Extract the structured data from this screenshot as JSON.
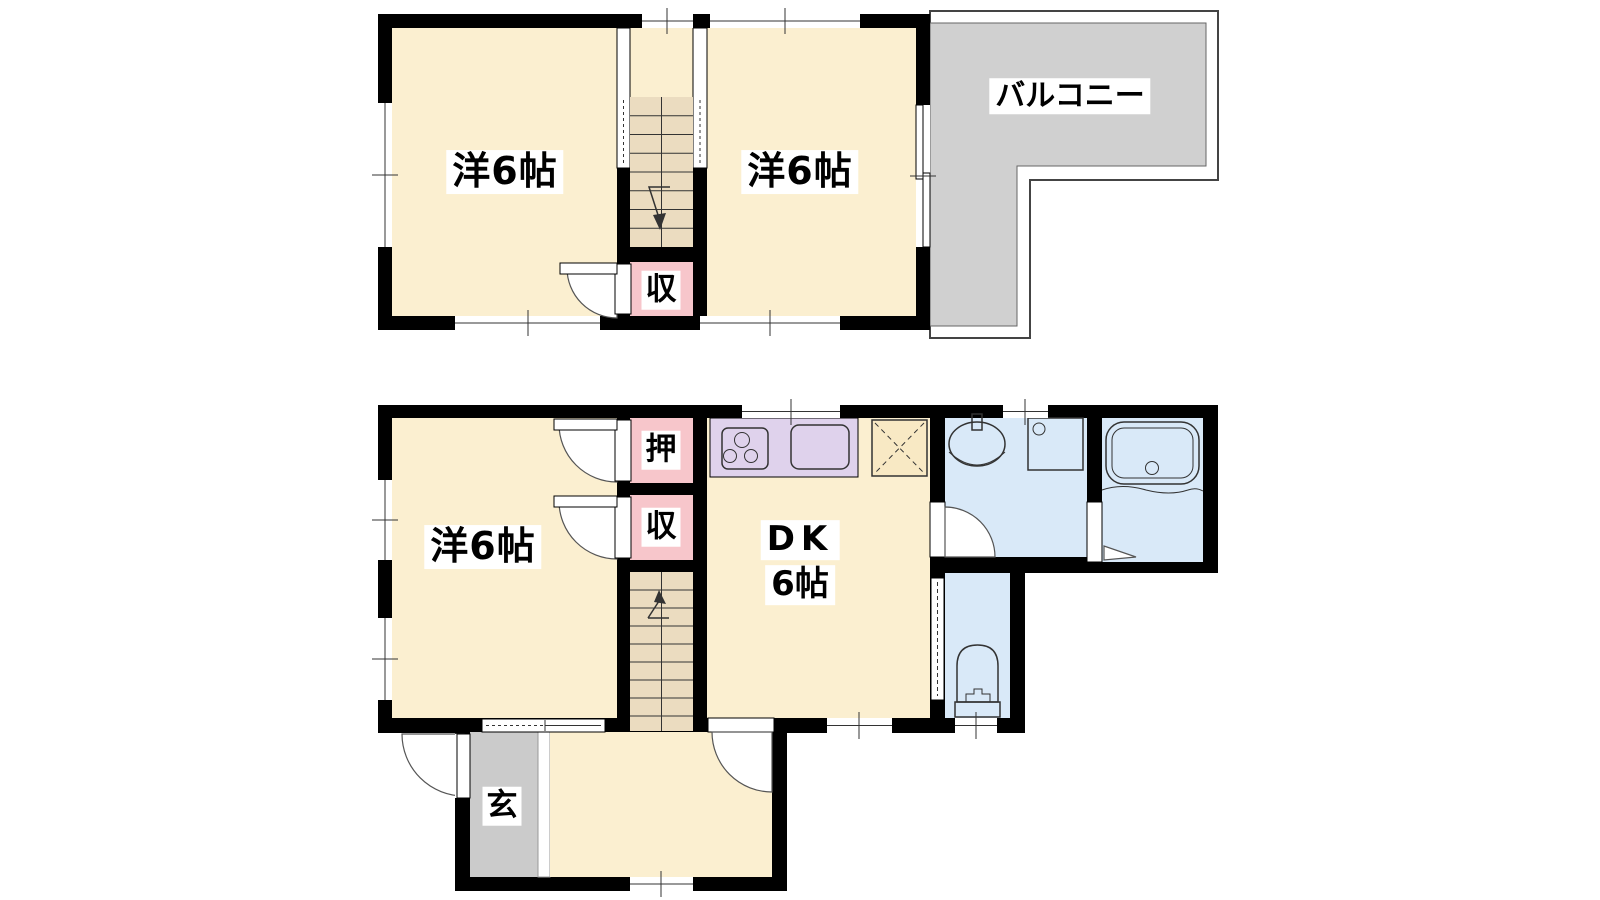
{
  "floor2": {
    "room_left": "洋6帖",
    "room_right": "洋6帖",
    "closet": "収",
    "balcony": "バルコニー"
  },
  "floor1": {
    "room": "洋6帖",
    "oshiire": "押",
    "closet": "収",
    "dk": "DK",
    "dk_size": "6帖",
    "entrance": "玄"
  },
  "icons": {
    "stove": "stove-icon",
    "kitchen_sink": "kitchen-sink-icon",
    "refrigerator": "refrigerator-space-icon",
    "washbasin": "washbasin-icon",
    "washing_machine": "washing-machine-icon",
    "bathtub": "bathtub-icon",
    "toilet": "toilet-icon",
    "stairs_up": "stairs-up-arrow-icon",
    "stairs_down": "stairs-down-arrow-icon"
  },
  "colors": {
    "wall": "#000000",
    "room": "#FBEFD0",
    "stair": "#EBDCC0",
    "closet": "#F7C6CB",
    "kitchen": "#DFD2EC",
    "bath": "#D9E9F8",
    "balcony": "#D0D0D0",
    "genkan": "#CBCBCB"
  }
}
